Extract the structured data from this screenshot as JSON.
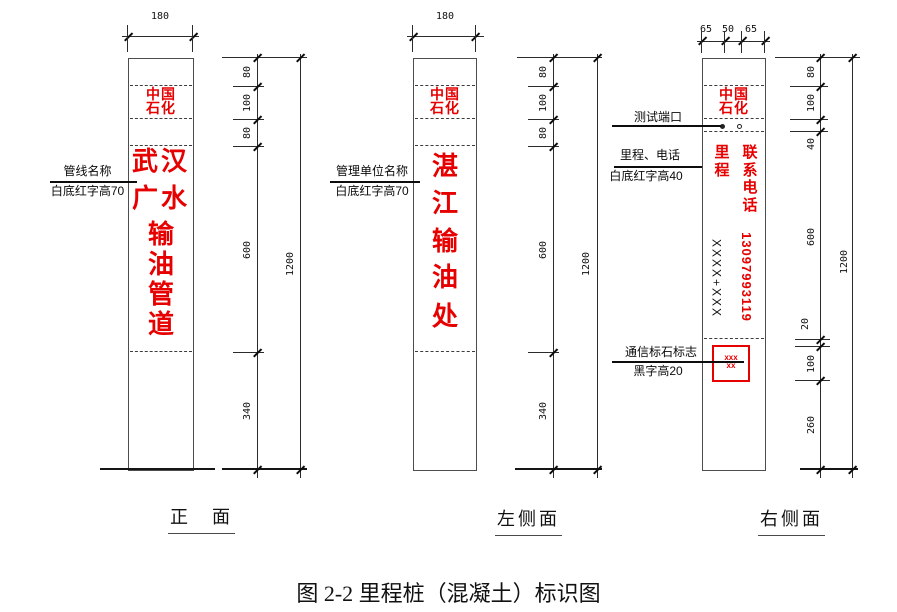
{
  "caption": "图 2-2 里程桩（混凝土）标识图",
  "colors": {
    "red": "#e60000",
    "line": "#2b2b2b"
  },
  "front": {
    "view_label": "正　面",
    "top_dim": "180",
    "logo": {
      "line1": "中国",
      "line2": "石化"
    },
    "name": {
      "row1": "武汉",
      "row2": "广水",
      "row3": "输",
      "row4": "油",
      "row5": "管",
      "row6": "道"
    },
    "annotation": {
      "line1": "管线名称",
      "line2": "白底红字高70"
    },
    "dims": {
      "d1": "80",
      "d2": "100",
      "d3": "80",
      "d4": "600",
      "d5": "340",
      "total": "1200"
    }
  },
  "left_side": {
    "view_label": "左侧面",
    "top_dim": "180",
    "logo": {
      "line1": "中国",
      "line2": "石化"
    },
    "name": {
      "c1": "湛",
      "c2": "江",
      "c3": "输",
      "c4": "油",
      "c5": "处"
    },
    "annotation": {
      "line1": "管理单位名称",
      "line2": "白底红字高70"
    },
    "dims": {
      "d1": "80",
      "d2": "100",
      "d3": "80",
      "d4": "600",
      "d5": "340",
      "total": "1200"
    }
  },
  "right_side": {
    "view_label": "右侧面",
    "top_dims": {
      "d1": "65",
      "d2": "50",
      "d3": "65"
    },
    "logo": {
      "line1": "中国",
      "line2": "石化"
    },
    "mileage": {
      "c1": "里",
      "c2": "程"
    },
    "contact": {
      "c1": "联",
      "c2": "系",
      "c3": "电",
      "c4": "话",
      "number": "13097993119"
    },
    "mileage_value": "XXXX+XXX",
    "marker_box": {
      "line1": "xxx",
      "line2": "xx"
    },
    "ann_test_port": "测试端口",
    "ann_mileage": {
      "line1": "里程、电话",
      "line2": "白底红字高40"
    },
    "ann_marker": {
      "line1": "通信标石标志",
      "line2": "黑字高20"
    },
    "dims": {
      "d1": "80",
      "d2": "100",
      "d3": "40",
      "d4": "600",
      "d5": "20",
      "d6": "100",
      "d7": "260",
      "total": "1200"
    }
  }
}
